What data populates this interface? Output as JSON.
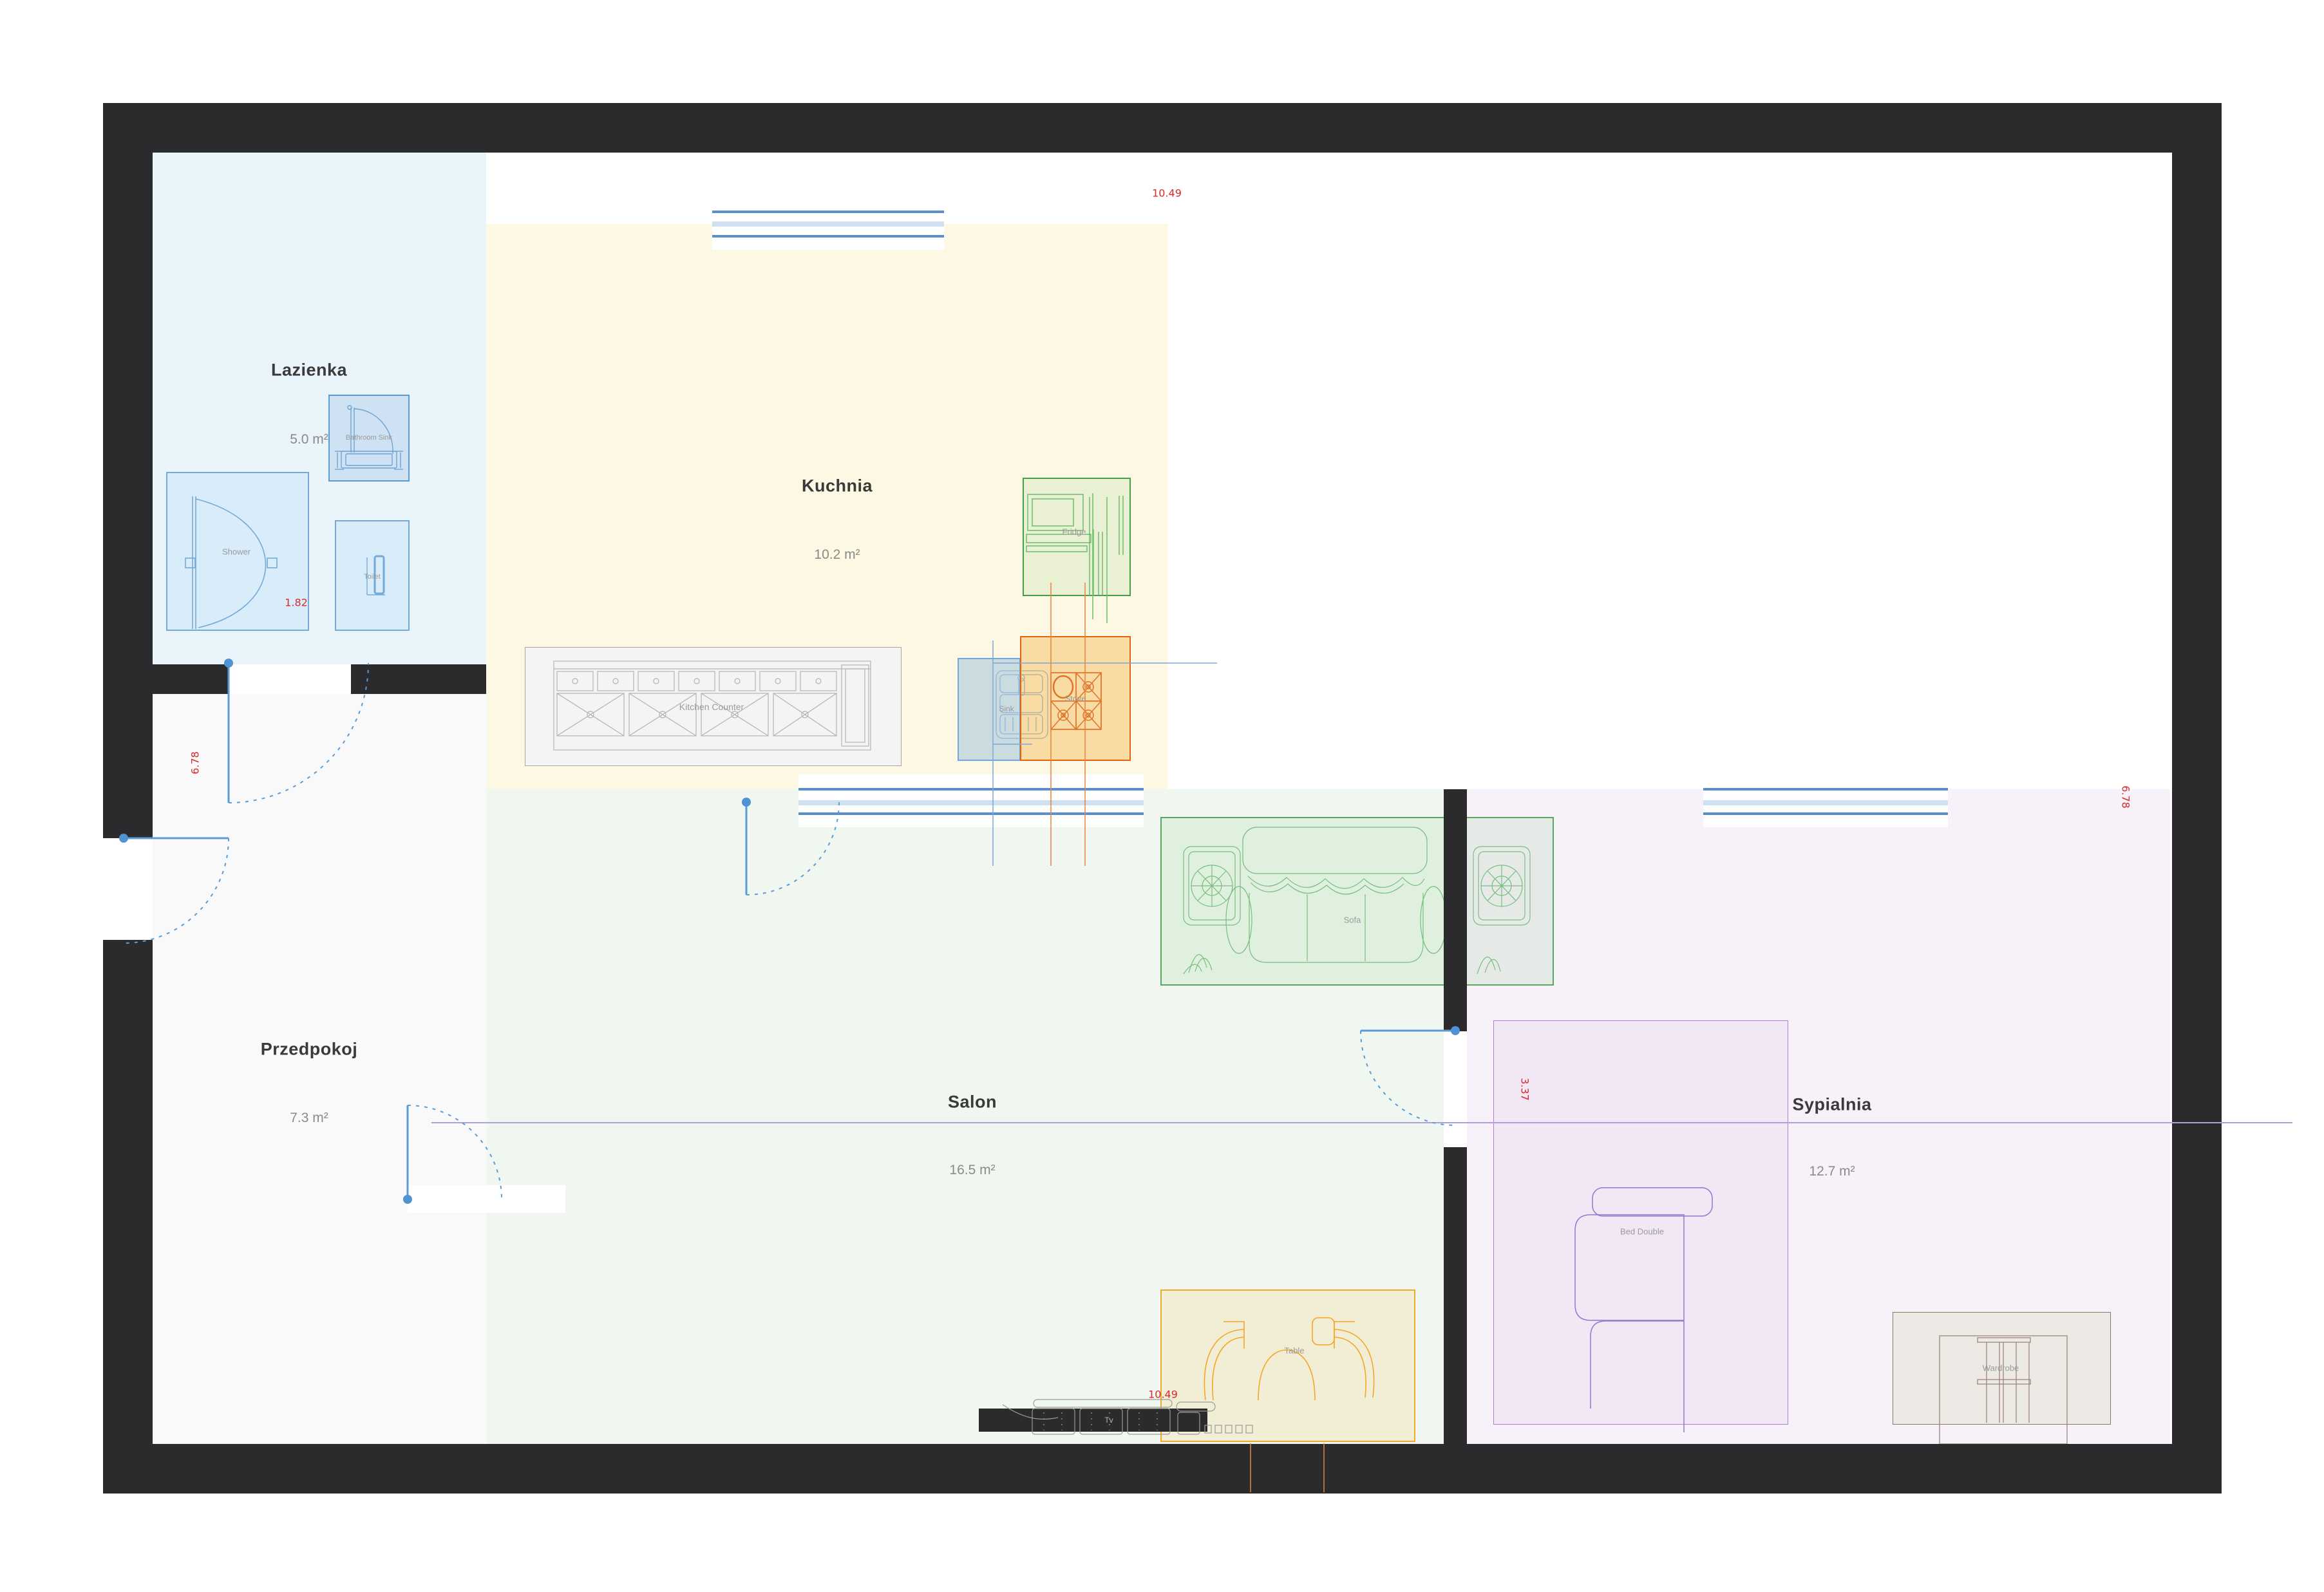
{
  "plan": {
    "title": "Apartment floor plan",
    "rooms": [
      {
        "id": "lazienka",
        "name": "Lazienka",
        "area": "5.0 m²"
      },
      {
        "id": "kuchnia",
        "name": "Kuchnia",
        "area": "10.2 m²"
      },
      {
        "id": "przedpokoj",
        "name": "Przedpokoj",
        "area": "7.3 m²"
      },
      {
        "id": "salon",
        "name": "Salon",
        "area": "16.5 m²"
      },
      {
        "id": "sypialnia",
        "name": "Sypialnia",
        "area": "12.7 m²"
      }
    ],
    "furniture": {
      "shower": "Shower",
      "bathroom_sink": "Bathroom Sink",
      "toilet": "Toilet",
      "kitchen_counter": "Kitchen Counter",
      "fridge": "Fridge",
      "sink": "Sink",
      "stove": "Stove",
      "sofa": "Sofa",
      "table": "Table",
      "tv": "Tv",
      "bed": "Bed Double",
      "wardrobe": "Wardrobe"
    },
    "dimensions": {
      "top": "10.49",
      "bottom": "10.49",
      "left": "6.78",
      "right": "6.78",
      "bedroom": "3.37",
      "shower": "1.82"
    },
    "colors": {
      "wall": "#2b2b2d",
      "window_frame": "#5b8fc9",
      "window_glass": "#cfe0f1",
      "door": "#5b9bd5",
      "dimension_red": "#d92b2b",
      "bathroom_fill": "#eaf4fb",
      "kitchen_fill": "#fcf8e3",
      "hall_fill": "#f9f9f9",
      "salon_fill": "#f0f7f1",
      "bedroom_fill": "#f7f1f9",
      "fridge_accent": "#43a047",
      "stove_accent": "#e2640e",
      "sink_accent": "#6fa8dc",
      "sofa_accent": "#56a95c",
      "table_accent": "#f0a832",
      "bed_accent": "#a87fd0",
      "wardrobe_accent": "#8d7568"
    }
  }
}
